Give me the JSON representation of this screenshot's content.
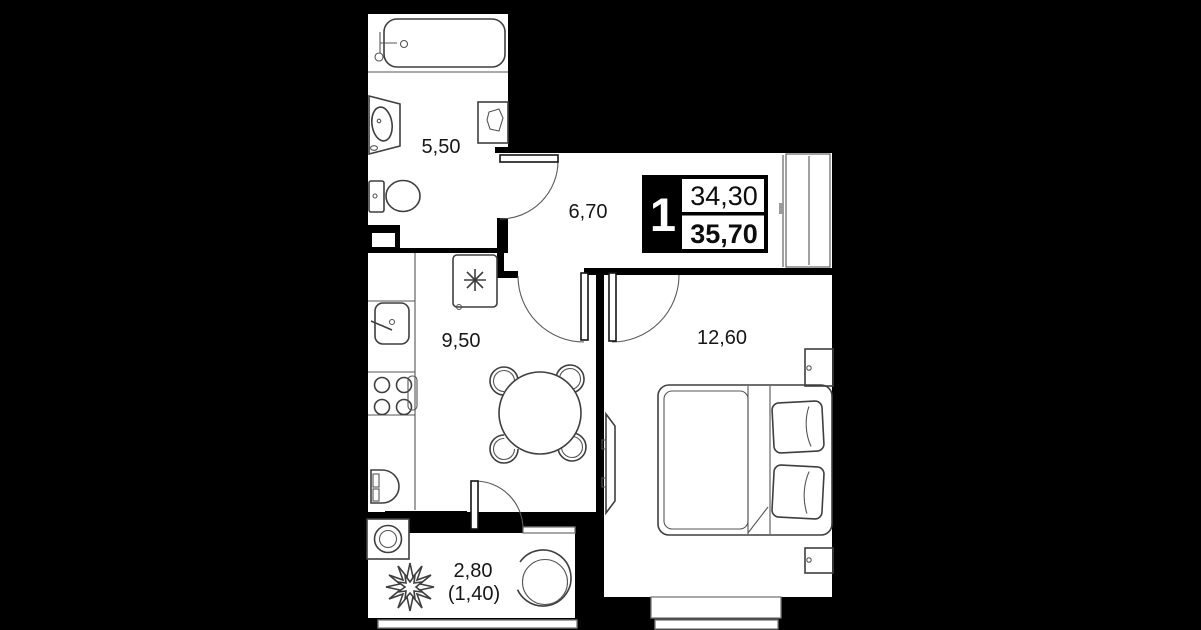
{
  "plan": {
    "badge": {
      "rooms_count": "1",
      "upper_area": "34,30",
      "lower_area": "35,70"
    },
    "rooms": {
      "bathroom": {
        "label": "5,50"
      },
      "hallway": {
        "label": "6,70"
      },
      "kitchen": {
        "label": "9,50"
      },
      "bedroom": {
        "label": "12,60"
      },
      "balcony": {
        "label": "2,80",
        "label_secondary": "(1,40)"
      }
    },
    "colors": {
      "background": "#000000",
      "floor": "#ffffff",
      "walls": "#000000",
      "furniture_line": "#3f3f3f"
    }
  }
}
